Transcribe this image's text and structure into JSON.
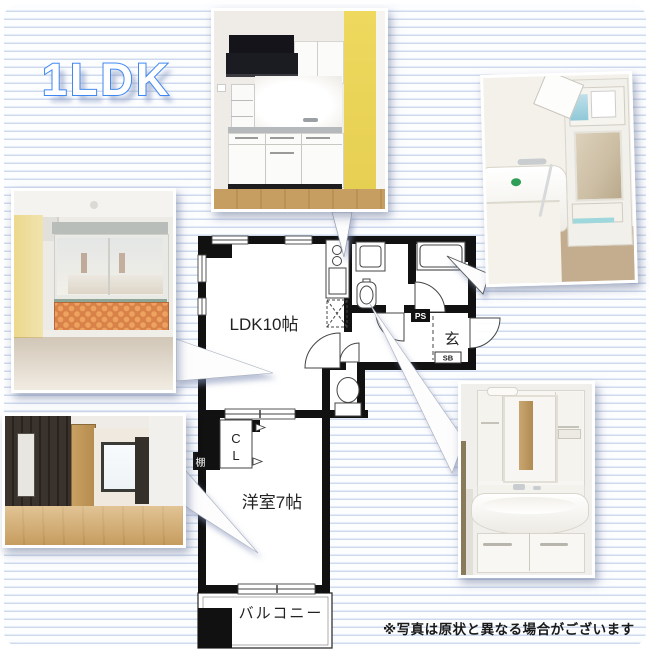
{
  "title": "1LDK",
  "disclaimer": "※写真は原状と異なる場合がございます",
  "floorplan": {
    "rooms": {
      "ldk": "LDK10帖",
      "western_room": "洋室7帖",
      "balcony": "バルコニー",
      "entrance": "玄"
    },
    "labels": {
      "closet_c": "C",
      "closet_l": "L",
      "ps": "PS",
      "sb": "SB",
      "shelf": "棚"
    }
  },
  "colors": {
    "title_outline": "#3f87f0",
    "background_stripe": "#cfdaee",
    "wall_black": "#111111",
    "accent_yellow": "#ecd76a",
    "accent_orange": "#d8824a",
    "wood_floor": "#c59b5f"
  }
}
